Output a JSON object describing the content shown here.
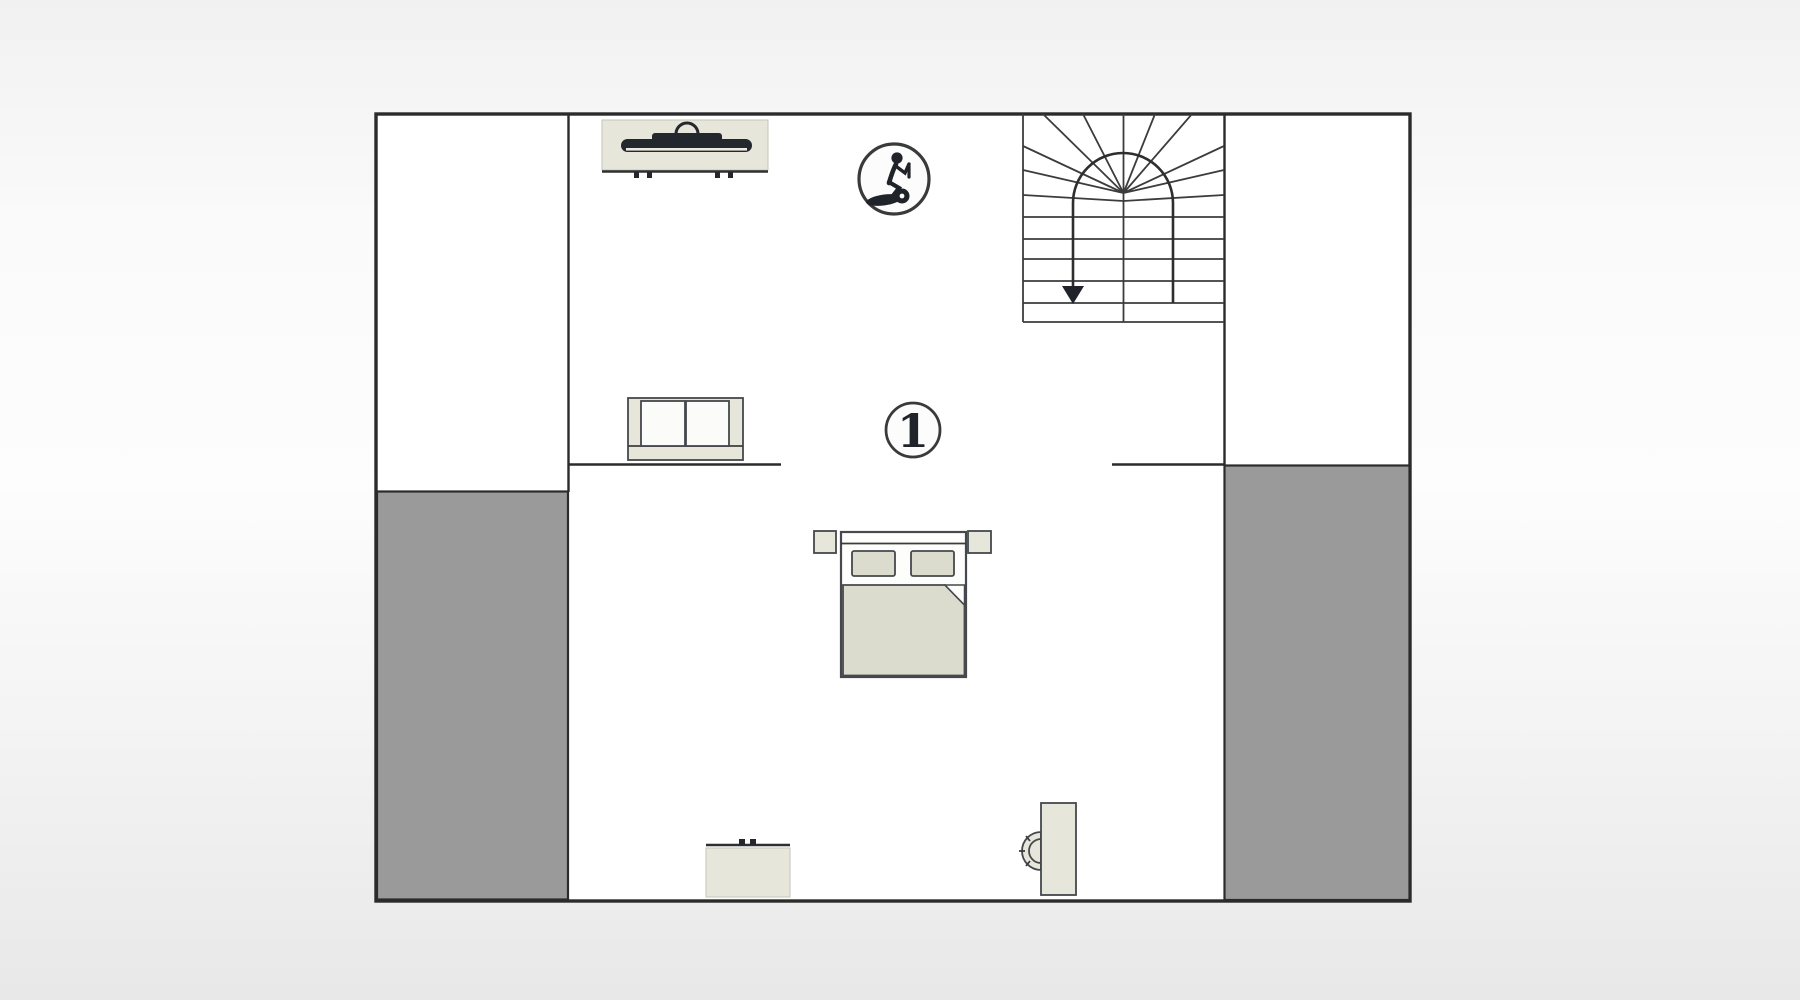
{
  "plan": {
    "room_label": "1",
    "stairs_direction": "down"
  },
  "icons": [
    {
      "name": "exercise-bike-icon"
    },
    {
      "name": "stairs-down-arrow-icon"
    }
  ],
  "furniture": [
    {
      "name": "tv-sideboard"
    },
    {
      "name": "staircase"
    },
    {
      "name": "sofa"
    },
    {
      "name": "double-bed"
    },
    {
      "name": "nightstand-left"
    },
    {
      "name": "nightstand-right"
    },
    {
      "name": "dresser"
    },
    {
      "name": "desk"
    },
    {
      "name": "desk-chair"
    }
  ],
  "colors": {
    "bg_top": "#f1f1f1",
    "bg_mid": "#fafafa",
    "bg_bottom": "#e8e8e8",
    "floor": "#ffffff",
    "wall": "#2b2b2b",
    "roof_area": "#9a9a9a",
    "furniture_fill": "#e6e6da",
    "bedding_fill": "#dcdcce",
    "cushion_fill": "#fbfbfa",
    "dark_accent": "#23272e",
    "badge_bg": "#fcfcfc",
    "badge_ring": "#3a3a3a",
    "badge_glyph": "#20242a"
  }
}
